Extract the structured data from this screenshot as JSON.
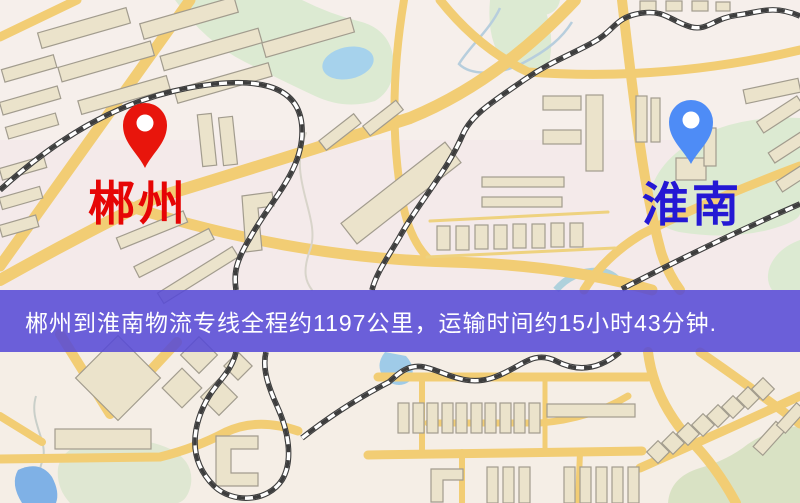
{
  "banner": {
    "text": "郴州到淮南物流专线全程约1197公里，运输时间约15小时43分钟.",
    "background_color": "rgba(86,74,214,0.87)",
    "text_color": "#ffffff"
  },
  "markers": {
    "origin": {
      "label": "郴州",
      "pin_color": "#e8150c",
      "label_color": "#e60505"
    },
    "destination": {
      "label": "淮南",
      "pin_color": "#4e8cf6",
      "label_color": "#2418d4"
    }
  },
  "route_info": {
    "origin": "郴州",
    "destination": "淮南",
    "service": "物流专线",
    "distance_text": "约1197公里",
    "duration_text": "约15小时43分钟"
  },
  "map_colors": {
    "base": "#f6efeb",
    "road_yellow": "#f2cd74",
    "building_fill": "#ebe3cb",
    "building_outline": "#a29c8e",
    "park_green": "#dcead2",
    "water_blue": "#a6d2ec",
    "railway_dark": "#3d3d3d"
  }
}
